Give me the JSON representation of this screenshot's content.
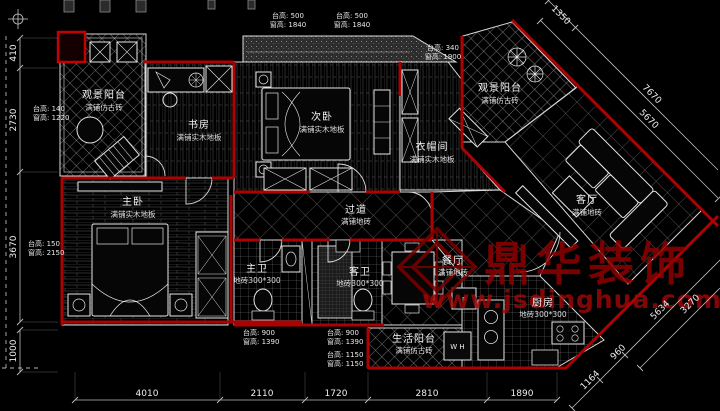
{
  "colors": {
    "background": "#000000",
    "wall_red": "#ad0202",
    "line_white": "#e0e0e0",
    "dim_gray": "#c8c8c8",
    "watermark_red": "#8e0000"
  },
  "rooms": [
    {
      "id": "balcony-tl",
      "name": "观景阳台",
      "floor": "满铺仿古砖"
    },
    {
      "id": "study",
      "name": "书房",
      "floor": "满铺实木地板"
    },
    {
      "id": "bedroom2",
      "name": "次卧",
      "floor": "满铺实木地板"
    },
    {
      "id": "cloakroom",
      "name": "衣帽间",
      "floor": "满铺实木地板"
    },
    {
      "id": "balcony-tr",
      "name": "观景阳台",
      "floor": "满铺仿古砖"
    },
    {
      "id": "living",
      "name": "客厅",
      "floor": "满铺地砖"
    },
    {
      "id": "corridor",
      "name": "过道",
      "floor": "满铺地砖"
    },
    {
      "id": "master",
      "name": "主卧",
      "floor": "满铺实木地板"
    },
    {
      "id": "bath-master",
      "name": "主卫",
      "floor": "地砖300*300"
    },
    {
      "id": "bath-guest",
      "name": "客卫",
      "floor": "地砖300*300"
    },
    {
      "id": "dining",
      "name": "餐厅",
      "floor": "满铺地砖"
    },
    {
      "id": "kitchen",
      "name": "厨房",
      "floor": "地砖300*300"
    },
    {
      "id": "balcony-life",
      "name": "生活阳台",
      "floor": "满铺仿古砖"
    }
  ],
  "window_notes": [
    {
      "line1": "台高: 500",
      "line2": "窗高: 1840"
    },
    {
      "line1": "台高: 500",
      "line2": "窗高: 1840"
    },
    {
      "line1": "台高: 340",
      "line2": "窗高: 1900"
    },
    {
      "line1": "台高: 140",
      "line2": "窗高: 1220"
    },
    {
      "line1": "台高: 150",
      "line2": "窗高: 2150"
    },
    {
      "line1": "台高: 900",
      "line2": "窗高: 1390"
    },
    {
      "line1": "台高: 900",
      "line2": "窗高: 1390"
    },
    {
      "line1": "台高: 1150",
      "line2": "窗高: 1150"
    }
  ],
  "dimensions": {
    "left": [
      "410",
      "2730",
      "3670",
      "1000"
    ],
    "bottom": [
      "4010",
      "2110",
      "1720",
      "2810",
      "1890"
    ],
    "diagonal_top_right": [
      "1350",
      "7670",
      "5670"
    ],
    "diagonal_bottom_right": [
      "1164",
      "960",
      "5634",
      "3270"
    ]
  },
  "appliances": {
    "washer": "W H",
    "fridge": "F"
  },
  "watermark": {
    "brand": "鼎华装饰",
    "url": "www.jsdinghua.com"
  }
}
